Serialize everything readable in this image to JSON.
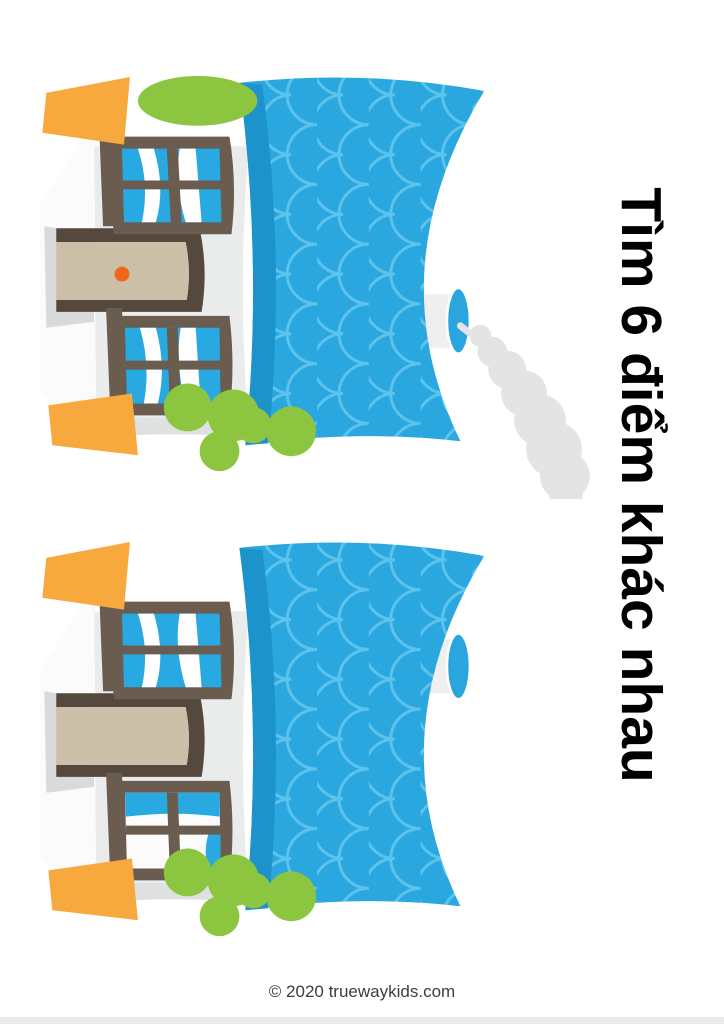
{
  "page": {
    "title": "Tìm 6 điểm khác nhau",
    "credit": "© 2020 truewaykids.com"
  },
  "puzzle": {
    "type": "spot-the-difference",
    "differences_to_find": 6,
    "houses": [
      {
        "name": "top house",
        "chimney_offset_x": 0,
        "smoke": true,
        "left_pot": {
          "plant": true
        },
        "door": {
          "knob": true
        },
        "left_window": {
          "horizontal_bar": true,
          "vertical_bar": true
        },
        "right_window": {
          "blue_glass": true,
          "pale_glass": false
        }
      },
      {
        "name": "bottom house",
        "chimney_offset_x": -120,
        "smoke": false,
        "left_pot": {
          "plant": false
        },
        "door": {
          "knob": false
        },
        "left_window": {
          "horizontal_bar": false,
          "vertical_bar": true
        },
        "right_window": {
          "blue_glass": false,
          "pale_glass": true
        }
      }
    ]
  },
  "colors": {
    "page": "#FFFFFF",
    "title": "#000000",
    "credit": "#3D3D3D",
    "footer-strip": "#EAEAEA",
    "roof": "#2AA7DF",
    "roof-scallop": "#5CC3EC",
    "roof-eave": "#1D93CB",
    "wall": "#EAEBEB",
    "wall-side": "#FFFFFF",
    "wall-shade": "#DFE0E1",
    "plinth": "#FBFBFC",
    "step-shadow": "#D9DADB",
    "window-frame": "#6A5C4F",
    "glass": "#29A9E1",
    "cloud": "#FFFFFF",
    "pale-glass": "#FBFBFC",
    "door-frame": "#55483D",
    "door": "#CBBFA7",
    "knob": "#F1661F",
    "pot": "#F7A93E",
    "plant": "#8CC540",
    "chimney": "#EFEFEF",
    "chimney-cap": "#2BA5DE",
    "smoke": "#E4E4E4"
  }
}
